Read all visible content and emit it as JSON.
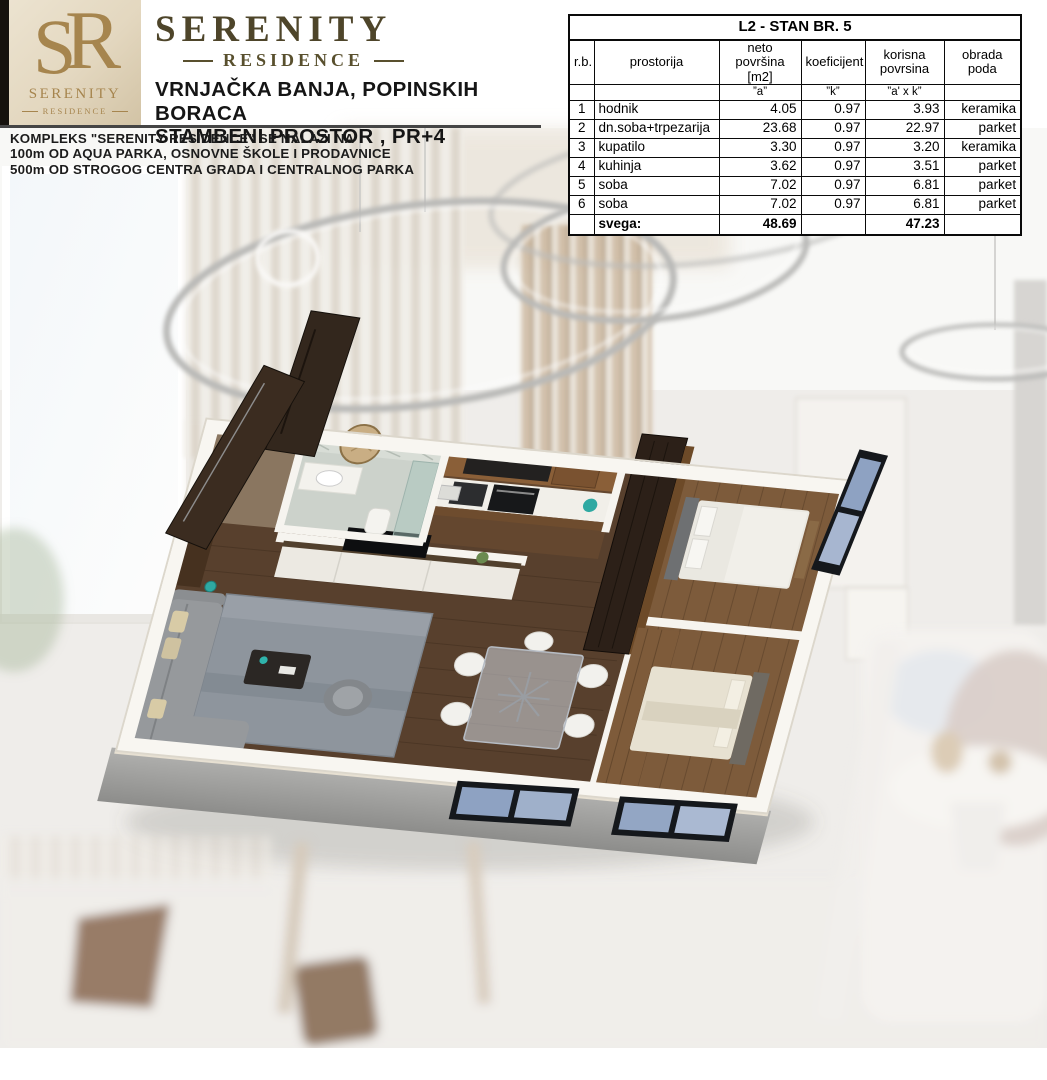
{
  "branding": {
    "monogram_s": "S",
    "monogram_r": "R",
    "logo_wordmark": "SERENITY",
    "logo_tagline": "RESIDENCE",
    "title": "SERENITY",
    "subtitle": "RESIDENCE",
    "address_line1": "VRNJAČKA BANJA, POPINSKIH BORACA",
    "address_line2": "STAMBENI PROSTOR , PR+4"
  },
  "location_info": {
    "line1": "KOMPLEKS \"SERENITY RESIDENCE\" SE NALAZI NA",
    "line2": "100m OD AQUA PARKA, OSNOVNE ŠKOLE I PRODAVNICE",
    "line3": "500m OD STROGOG CENTRA GRADA I CENTRALNOG PARKA"
  },
  "table": {
    "title": "L2 - STAN BR. 5",
    "headers": [
      "r.b.",
      "prostorija",
      "neto površina\n[m2]",
      "koeficijent",
      "korisna\npovrsina",
      "obrada poda"
    ],
    "subheaders": [
      "",
      "",
      "”a”",
      "”k”",
      "”a' x k”",
      ""
    ],
    "rows": [
      [
        "1",
        "hodnik",
        "4.05",
        "0.97",
        "3.93",
        "keramika"
      ],
      [
        "2",
        "dn.soba+trpezarija",
        "23.68",
        "0.97",
        "22.97",
        "parket"
      ],
      [
        "3",
        "kupatilo",
        "3.30",
        "0.97",
        "3.20",
        "keramika"
      ],
      [
        "4",
        "kuhinja",
        "3.62",
        "0.97",
        "3.51",
        "parket"
      ],
      [
        "5",
        "soba",
        "7.02",
        "0.97",
        "6.81",
        "parket"
      ],
      [
        "6",
        "soba",
        "7.02",
        "0.97",
        "6.81",
        "parket"
      ]
    ],
    "total_row": [
      "",
      "svega:",
      "48.69",
      "",
      "47.23",
      ""
    ]
  },
  "colors": {
    "brand_gold": "#a6854e",
    "brand_bronze": "#4e452a",
    "accent_teal": "#2fa9a2",
    "floor_wood_dark": "#58402d",
    "floor_wood_light": "#7d5b3b",
    "window_glass_blue": "#8ea2c2",
    "window_frame_black": "#15181c",
    "wall_white": "#f6f4ef",
    "plinth_gray": "#9e9e9c"
  }
}
